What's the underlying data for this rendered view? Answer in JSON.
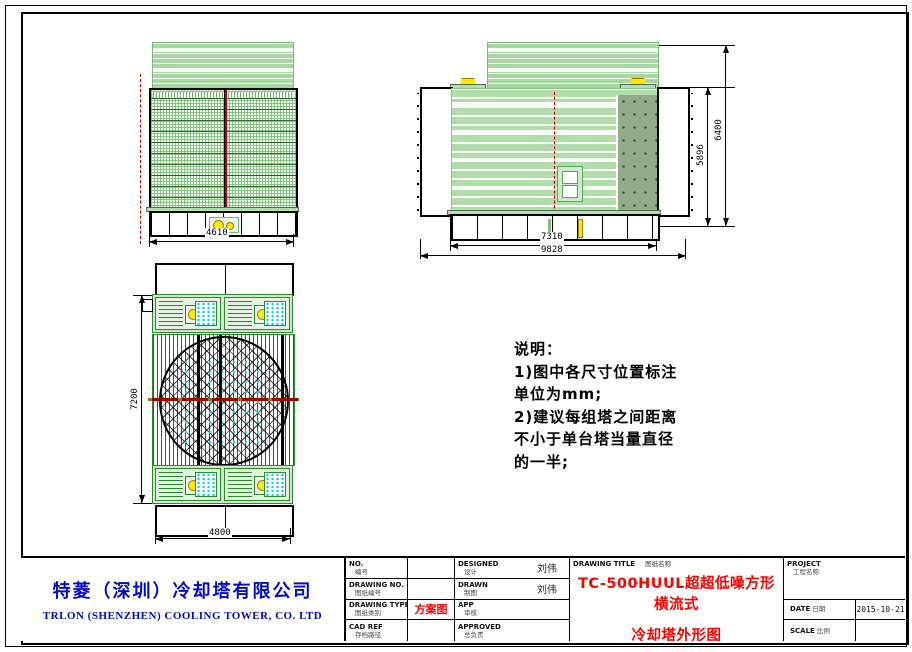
{
  "front_view": {
    "width_dim": "4610"
  },
  "side_view": {
    "inner_width_dim": "7310",
    "overall_width_dim": "9828",
    "body_height_dim": "5896",
    "overall_height_dim": "6400"
  },
  "plan_view": {
    "depth_dim": "7200",
    "width_dim": "4800"
  },
  "notes": {
    "title": "说明：",
    "line1": "1)图中各尺寸位置标注",
    "line2": "单位为mm;",
    "line3": "2)建议每组塔之间距离",
    "line4": "不小于单台塔当量直径",
    "line5": "的一半;"
  },
  "company": {
    "name_cn": "特菱（深圳）冷却塔有限公司",
    "name_en": "TRLON (SHENZHEN) COOLING TOWER, CO. LTD"
  },
  "titleblock": {
    "no": {
      "en": "NO.",
      "cn": "编号",
      "value": ""
    },
    "drawing_no": {
      "en": "DRAWING NO.",
      "cn": "图纸编号",
      "value": ""
    },
    "drawing_type": {
      "en": "DRAWING TYPE",
      "cn": "图纸类别",
      "value": "方案图"
    },
    "cad_ref": {
      "en": "CAD REF",
      "cn": "存档路径",
      "value": ""
    },
    "designed": {
      "en": "DESIGNED",
      "cn": "设计",
      "value": "刘伟"
    },
    "drawn": {
      "en": "DRAWN",
      "cn": "制图",
      "value": "刘伟"
    },
    "app": {
      "en": "APP",
      "cn": "审核",
      "value": ""
    },
    "approved": {
      "en": "APPROVED",
      "cn": "总负责",
      "value": ""
    },
    "drawing_title": {
      "label_en": "DRAWING TITLE",
      "label_cn": "图纸名称",
      "line1": "TC-500HUUL超超低噪方形横流式",
      "line2": "冷却塔外形图"
    },
    "project": {
      "label_en": "PROJECT",
      "label_cn": "工程名称",
      "value": ""
    },
    "date": {
      "label_en": "DATE",
      "label_cn": "日期",
      "value": "2015-10-21"
    },
    "scale": {
      "label_en": "SCALE",
      "label_cn": "比例",
      "value": ""
    }
  },
  "colors": {
    "brand_blue": "#0008cc",
    "accent_red": "#ff0000",
    "casing_green": "#a9d7a4",
    "panel_olive": "#95a98b",
    "detail_yellow": "#ffe800",
    "detail_cyan": "#00cfe0"
  }
}
